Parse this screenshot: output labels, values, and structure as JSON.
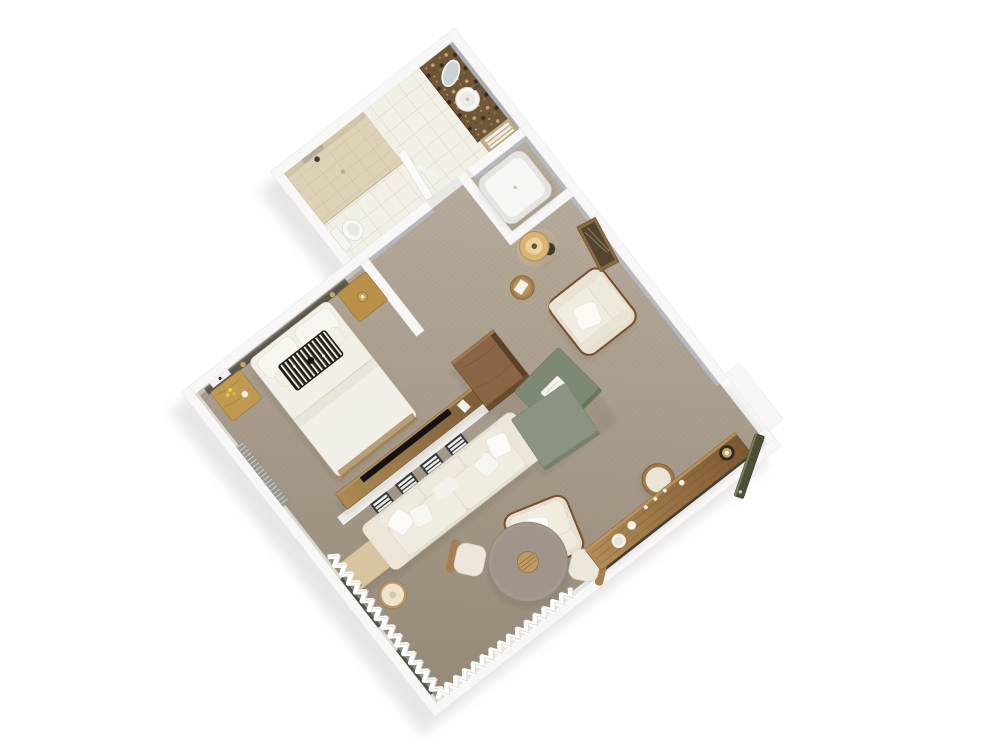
{
  "scene": {
    "type": "3d-floorplan-render",
    "view": "isometric-top-down, plan rotated ~38 degrees, white background",
    "rooms": [
      {
        "name": "bedroom",
        "furniture": [
          "king-bed",
          "headboard-wall-panel",
          "crystal-chandelier",
          "nightstand-west",
          "nightstand-east",
          "wall-mounted-panel",
          "tv-console",
          "tv",
          "window-bench",
          "louvered-window"
        ]
      },
      {
        "name": "living-area",
        "furniture": [
          "sofa",
          "divider-shelf-niches",
          "coffee-table-set",
          "armchair-east",
          "armchair-south",
          "drum-side-table",
          "floor-lamp",
          "corner-side-table",
          "leaning-artwork",
          "tall-wood-cabinet"
        ]
      },
      {
        "name": "dining-area",
        "furniture": [
          "round-dining-table",
          "dining-chair-northwest",
          "dining-chair-southeast",
          "wooden-desk",
          "desk-stool",
          "desk-lamp",
          "decor-bowl"
        ]
      },
      {
        "name": "bathroom",
        "furniture": [
          "walk-in-shower",
          "shower-glass-door",
          "toilet",
          "marble-vanity",
          "vessel-sink",
          "round-mirror",
          "towel-shelf",
          "bathtub",
          "bathroom-door"
        ]
      },
      {
        "name": "entry",
        "furniture": [
          "entry-door",
          "threshold"
        ]
      }
    ],
    "windows": [
      "west-wall-sheer-curtains",
      "south-wall-sheer-curtains",
      "bedroom-louvered-blinds",
      "desk-window-strip"
    ]
  },
  "palette": {
    "background": "#ffffff",
    "wall": "#f8f7f5",
    "wall_face": "#b4b8c0",
    "carpet": "#a79c8b",
    "headboard_panel": "#5d564f",
    "bedding": "#f2efe8",
    "sofa": "#e6e0d3",
    "armchair": "#e6e0d3",
    "coffee_table": "#8b9482",
    "coffee_table_dark": "#7e8974",
    "entry_door": "#4c4f36",
    "cabinet_wood": "#8a6544",
    "dining_top": "#a0958a",
    "brass": "#c9a66a",
    "lamp_shade": "#d9b475",
    "tile": "#f2efe7",
    "shower_tile": "#ddd2b5",
    "marble": "#6e5637",
    "tub": "#f7f6f3",
    "mirror": "#ccd3d6",
    "bench": "#d8c59f",
    "tv": "#141312",
    "chandelier": "#1a1410"
  }
}
